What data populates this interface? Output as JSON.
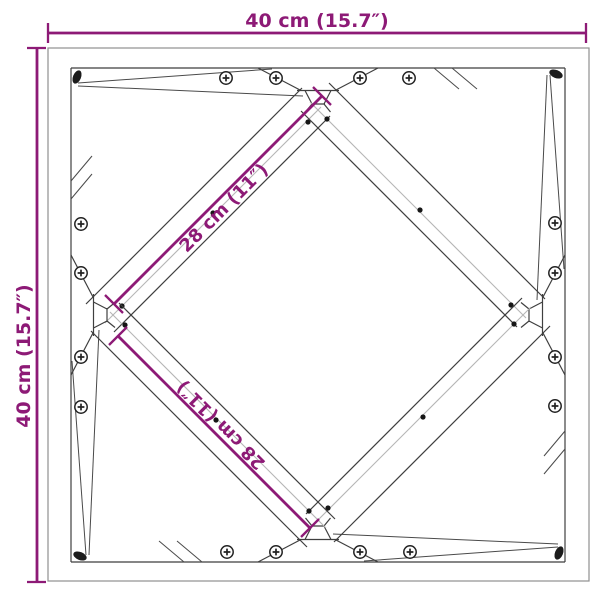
{
  "diagram": {
    "top_dimension": "40 cm (15.7″)",
    "left_dimension": "40 cm (15.7″)",
    "diagonal_dimension_upper": "28 cm (11″)",
    "diagonal_dimension_lower": "28 cm (11″)",
    "colors": {
      "dimension_accent": "#8d1a76",
      "drawing_line": "#3f3f3f",
      "drawing_line_light": "#b5b5b5",
      "outer_edge": "#8f8f8f",
      "background": "#ffffff"
    }
  }
}
